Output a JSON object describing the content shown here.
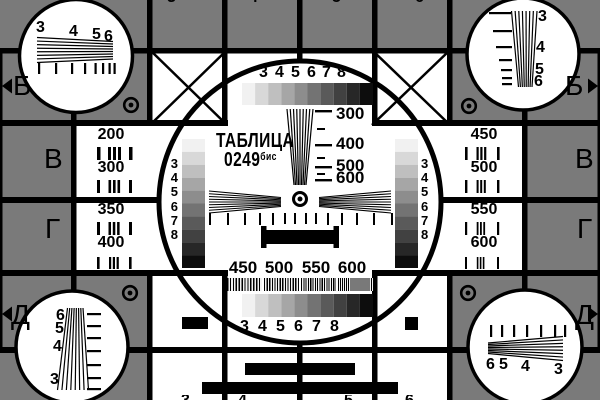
{
  "card": {
    "title": "ТАБЛИЦА",
    "code": "0249",
    "code_suffix": "бис"
  },
  "colors": {
    "background": "#7a7a7a",
    "ink": "#000000",
    "paper": "#ffffff",
    "steps": [
      "#f1f1f1",
      "#d8d8d8",
      "#bfbfbf",
      "#a6a6a6",
      "#8d8d8d",
      "#737373",
      "#5a5a5a",
      "#414141",
      "#272727",
      "#0d0d0d"
    ]
  },
  "row_letters": {
    "b": "Б",
    "v": "В",
    "g": "Г",
    "d": "Д"
  },
  "grayscale_labels": [
    "3",
    "4",
    "5",
    "6",
    "7",
    "8"
  ],
  "corner_labels": [
    "3",
    "4",
    "5",
    "6"
  ],
  "frequency_ticks": [
    "300",
    "400",
    "500",
    "600"
  ],
  "burst_labels": [
    "450",
    "500",
    "550",
    "600"
  ],
  "left_cells": [
    "200",
    "300",
    "350",
    "400"
  ],
  "right_cells": [
    "450",
    "500",
    "550",
    "600"
  ],
  "partial_top": [
    "3",
    "4",
    "5",
    "6"
  ],
  "partial_bottom": [
    "3",
    "4",
    "5",
    "6"
  ]
}
